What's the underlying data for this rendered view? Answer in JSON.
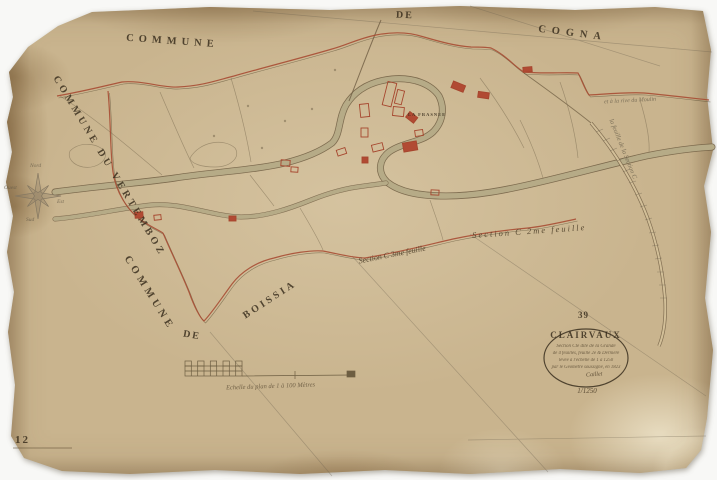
{
  "sheet": {
    "number": "12"
  },
  "neighbors": {
    "top_left": "COMMUNE",
    "top_center": "DE",
    "top_right": "COGNA",
    "west": "COMMUNE DU VERTEMBOZ",
    "southwest_commune": "COMMUNE",
    "southwest_de": "DE",
    "southwest_name": "BOISSIA"
  },
  "annotations": {
    "section_left": "Section C 3me feuille",
    "section_right": "Section C 2me feuille",
    "east_note_top": "et à la rive du Moulin",
    "east_note_diagonal": "la feuille de la Section C",
    "village_label": "LA FRASNEE"
  },
  "compass": {
    "north": "Nord",
    "east": "Est",
    "south": "Sud",
    "west": "Ouest"
  },
  "cartouche": {
    "plate_number": "39",
    "title": "CLAIRVAUX",
    "line1": "Section Cte dite de la Grande",
    "line2": "de 4 feuilles, feuille 2e & Dernière",
    "line3": "levée à l'échelle de 1 à 1250",
    "line4": "par le Géomètre soussigné, en 1823",
    "signature": "Caillet",
    "scale_fraction": "1/1250"
  },
  "scale_bar": {
    "caption": "Echelle du plan de 1 à 100 Mètres"
  },
  "colors": {
    "paper": "#c9b48e",
    "ink": "#4a3c28",
    "boundary_red": "#a6462e",
    "building_red": "#b14a33",
    "wash_green": "#7d8464",
    "pencil": "#6e6350"
  }
}
